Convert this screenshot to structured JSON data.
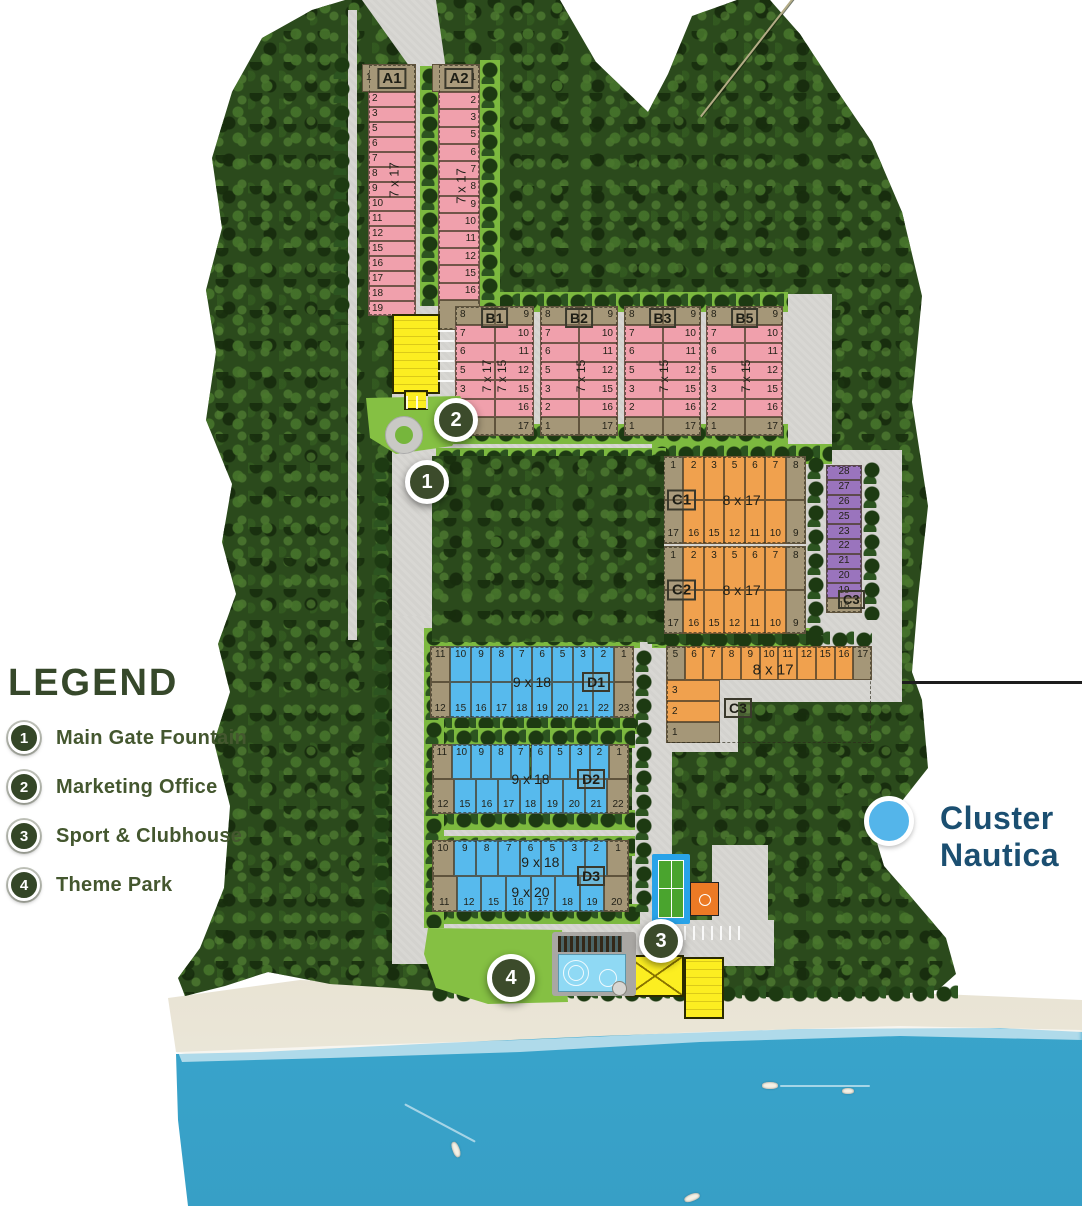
{
  "title": "Cluster Nautica siteplan",
  "cluster": {
    "line1": "Cluster",
    "line2": "Nautica"
  },
  "legend": {
    "title": "LEGEND",
    "items": [
      {
        "num": "1",
        "label": "Main Gate Fountain"
      },
      {
        "num": "2",
        "label": "Marketing Office"
      },
      {
        "num": "3",
        "label": "Sport & Clubhouse"
      },
      {
        "num": "4",
        "label": "Theme Park"
      }
    ]
  },
  "markers": [
    {
      "num": "1"
    },
    {
      "num": "2"
    },
    {
      "num": "3"
    },
    {
      "num": "4"
    }
  ],
  "colors": {
    "pink": "#f0a0ac",
    "tan": "#a59778",
    "orange": "#f0a14e",
    "blue": "#57baed",
    "purple": "#9a74bd",
    "road": "#d8d7d3",
    "forest": "#2b4a1c",
    "lawn": "#85c043",
    "sea": "#4ab4d6",
    "sand": "#cfc2a8",
    "legend_green": "#44572f",
    "nautica_blue": "#1b4f71",
    "nautica_circle": "#54b5ea",
    "marker_bg": "#3c4b2b",
    "building_yellow": "#fcee21"
  },
  "blocks": {
    "A1": {
      "label": "A1",
      "size": "7 x 17",
      "head": "1",
      "cells": [
        "2",
        "3",
        "5",
        "6",
        "7",
        "8",
        "9",
        "10",
        "11",
        "12",
        "15",
        "16",
        "17",
        "18",
        "19"
      ]
    },
    "A2": {
      "label": "A2",
      "size": "7 x 17",
      "head": "1",
      "cells": [
        "2",
        "3",
        "5",
        "6",
        "7",
        "8",
        "9",
        "10",
        "11",
        "12",
        "15",
        "16"
      ],
      "foot": "17"
    },
    "B1": {
      "label": "B1",
      "sizes": [
        "7 x 17",
        "7 x 15"
      ],
      "left": [
        "8",
        "7",
        "6",
        "5",
        "3",
        "2",
        "1"
      ],
      "right": [
        "9",
        "10",
        "11",
        "12",
        "15",
        "16",
        "17"
      ]
    },
    "B2": {
      "label": "B2",
      "sizes": [
        "7 x 15"
      ],
      "left": [
        "8",
        "7",
        "6",
        "5",
        "3",
        "2",
        "1"
      ],
      "right": [
        "9",
        "10",
        "11",
        "12",
        "15",
        "16",
        "17"
      ]
    },
    "B3": {
      "label": "B3",
      "sizes": [
        "7 x 15"
      ],
      "left": [
        "8",
        "7",
        "6",
        "5",
        "3",
        "2",
        "1"
      ],
      "right": [
        "9",
        "10",
        "11",
        "12",
        "15",
        "16",
        "17"
      ]
    },
    "B5": {
      "label": "B5",
      "sizes": [
        "7 x 15"
      ],
      "left": [
        "8",
        "7",
        "6",
        "5",
        "3",
        "2",
        "1"
      ],
      "right": [
        "9",
        "10",
        "11",
        "12",
        "15",
        "16",
        "17"
      ]
    },
    "C1": {
      "label": "C1",
      "size": "8 x 17",
      "top": [
        "1",
        "2",
        "3",
        "5",
        "6",
        "7",
        "8"
      ],
      "bottom": [
        "17",
        "16",
        "15",
        "12",
        "11",
        "10",
        "9"
      ]
    },
    "C2": {
      "label": "C2",
      "size": "8 x 17",
      "top": [
        "1",
        "2",
        "3",
        "5",
        "6",
        "7",
        "8"
      ],
      "bottom": [
        "17",
        "16",
        "15",
        "12",
        "11",
        "10",
        "9"
      ]
    },
    "C3_strip": {
      "label": "C3",
      "cells": [
        "28",
        "27",
        "26",
        "25",
        "23",
        "22",
        "21",
        "20",
        "19",
        "18"
      ]
    },
    "C3_row": {
      "label": "C3",
      "size": "8 x 17",
      "row": [
        "5",
        "6",
        "7",
        "8",
        "9",
        "10",
        "11",
        "12",
        "15",
        "16",
        "17"
      ],
      "arm": [
        "3",
        "2",
        "1"
      ]
    },
    "D1": {
      "label": "D1",
      "size_top": "9 x 18",
      "top": [
        "11",
        "10",
        "9",
        "8",
        "7",
        "6",
        "5",
        "3",
        "2",
        "1"
      ],
      "bottom": [
        "12",
        "15",
        "16",
        "17",
        "18",
        "19",
        "20",
        "21",
        "22",
        "23"
      ]
    },
    "D2": {
      "label": "D2",
      "size_top": "9 x 18",
      "top": [
        "11",
        "10",
        "9",
        "8",
        "7",
        "6",
        "5",
        "3",
        "2",
        "1"
      ],
      "bottom": [
        "12",
        "15",
        "16",
        "17",
        "18",
        "19",
        "20",
        "21",
        "22"
      ]
    },
    "D3": {
      "label": "D3",
      "size_top": "9 x 18",
      "size_bottom": "9 x 20",
      "top": [
        "10",
        "9",
        "8",
        "7",
        "6",
        "5",
        "3",
        "2",
        "1"
      ],
      "bottom": [
        "11",
        "12",
        "15",
        "16",
        "17",
        "18",
        "19",
        "20"
      ]
    }
  }
}
